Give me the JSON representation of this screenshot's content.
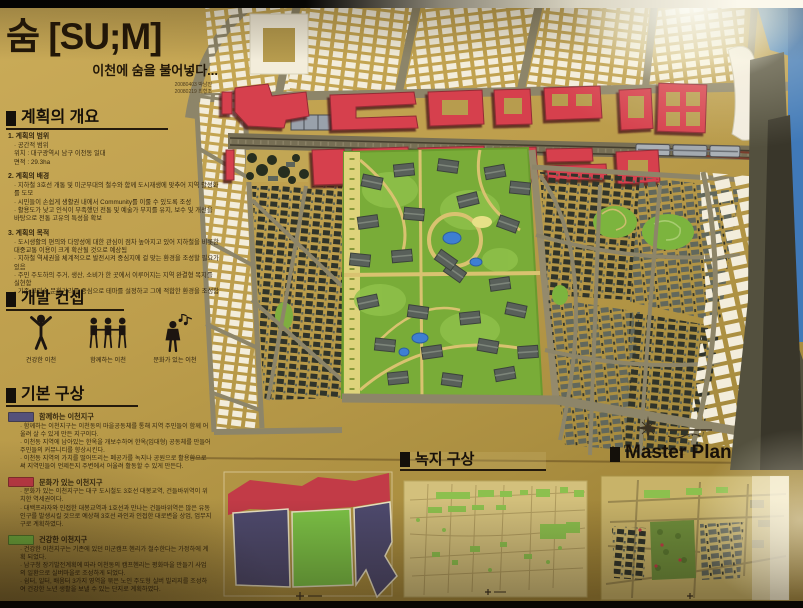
{
  "board": {
    "title": "숨 [SU;M]",
    "subtitle": "이천에 숨을 불어넣다...",
    "credits": [
      "20080403 박남진",
      "20080219 최형조"
    ],
    "overview": {
      "heading": "계획의 개요",
      "items": [
        {
          "title": "1. 계획의 범위",
          "lines": [
            "· 공간적 범위",
            "위치 : 대구광역시 남구 이천동 일대",
            "면적 : 29.3ha"
          ]
        },
        {
          "title": "2. 계획의 배경",
          "lines": [
            "· 지하철 3호선 개통 및 미군부대의 철수와 함께 도시재생에 맞추어 지역 활성화를 도모",
            "· 시민들이 손쉽게 생활권 내에서 Community를 이룰 수 있도록 조성",
            "· 활용도가 낮고 인식이 부족했던 전통 및 예술가 부지를 유지, 보수 및 개선을 바탕으로 전통 고유의 특성을 확보"
          ]
        },
        {
          "title": "3. 계획의 목적",
          "lines": [
            "· 도시생활의 편의와 다양성에 대한 관심이 점차 높아지고 있어 지하철을 비롯한 대중교통 이용이 크게 확산될 것으로 예상됨",
            "· 지하철 역세권을 체계적으로 발전시켜 중심지에 걸 맞는 환경을 조성할 필요가 있음",
            "· 주민 주도하의 주거, 생산, 소비가 한 곳에서 이루어지는 지역 완결형 복지를 실현함",
            "· 기존 고미술 문화거리를 중심으로 테마를 설정하고 그에 적합한 환경을 조성함"
          ]
        }
      ]
    },
    "concept": {
      "heading": "개발 컨셉",
      "items": [
        {
          "label": "건강한 이천",
          "icon": "person-arms-raised-icon"
        },
        {
          "label": "함께하는 이천",
          "icon": "people-holding-hands-icon"
        },
        {
          "label": "문화가 있는 이천",
          "icon": "person-with-music-icon"
        }
      ]
    },
    "basic": {
      "heading": "기본 구상",
      "zones": [
        {
          "title": "함께하는 이천지구",
          "color": "#54517a",
          "lines": [
            "· 함께하는 이천지구는 이천동의 마을공동체를 통해 지역 주민들이 함께 어울려 살 수 있게 만든 지구이다.",
            "· 이천동 지역에 남아있는 한옥을 개보수하여 한옥(임대형) 공동체를 만들어 주민들의 커뮤니티를 향상시킨다.",
            "· 이천동 지역의 가치를 떨어뜨리는 폐공가를 녹지나 공원으로 활용함으로써 지역민들이 언제든지 주변에서 어울려 활동할 수 있게 만든다."
          ]
        },
        {
          "title": "문화가 있는 이천지구",
          "color": "#c23b47",
          "lines": [
            "· 문화가 있는 이천지구는 대구 도시철도 3호선 대봉교역, 건들바위역이 위치한 역세권이다.",
            "· 대백프라자와 인접한 대봉교역과 1호선과 만나는 건들바위역은 많은 유동인구를 발생시킬 것으로 예상해 3호선 라인과 인접한 대로변을 상업, 업무지구로 계획하였다."
          ]
        },
        {
          "title": "건강한 이천지구",
          "color": "#7cc246",
          "lines": [
            "· 건강한 이천지구는 기존에 있던 미군캠프 헨리가 철수한다는 가정하에 계획 되었다.",
            "· 남구청 장기발전계획에 따라 이천동의 캠프헨리는 평화마을 만들기 사업의 일환으로 실버마을로 조성하게 되었다.",
            "· 쉼터, 일터, 배움터 3가지 영역을 묶은 노인 주도형 실버 빌리지를 조성하여 건강한 노년 생활을 보낼 수 있는 단지로 계획하였다."
          ]
        }
      ]
    },
    "green_plan": {
      "heading": "녹지 구상"
    },
    "master_plan": {
      "heading": "Master Plan"
    },
    "colors": {
      "board_tan": "#bb9c4a",
      "building_red": "#d6404e",
      "park_green": "#79ac38",
      "zone_blue": "#4e4a6e",
      "zone_green": "#7cc246",
      "zone_red": "#c23b47",
      "wall_blue": "#4e8ac4"
    }
  }
}
